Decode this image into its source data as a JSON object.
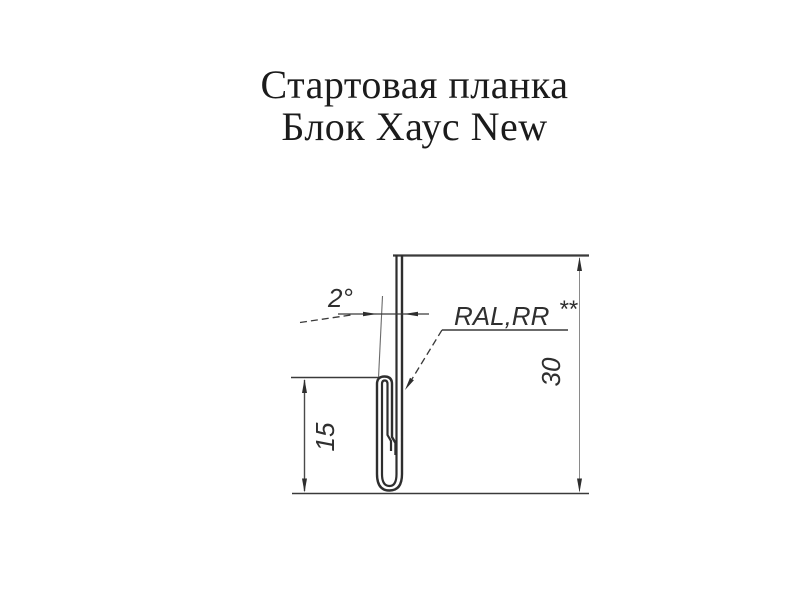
{
  "title": {
    "line1": "Стартовая планка",
    "line2": "Блок Хаус New"
  },
  "drawing": {
    "angle_label": "2°",
    "coating_label": "RAL,RR",
    "coating_superscript": "**",
    "height_dimension": "30",
    "lip_dimension": "15",
    "line_color": "#2e2e2e",
    "background_color": "#ffffff"
  }
}
